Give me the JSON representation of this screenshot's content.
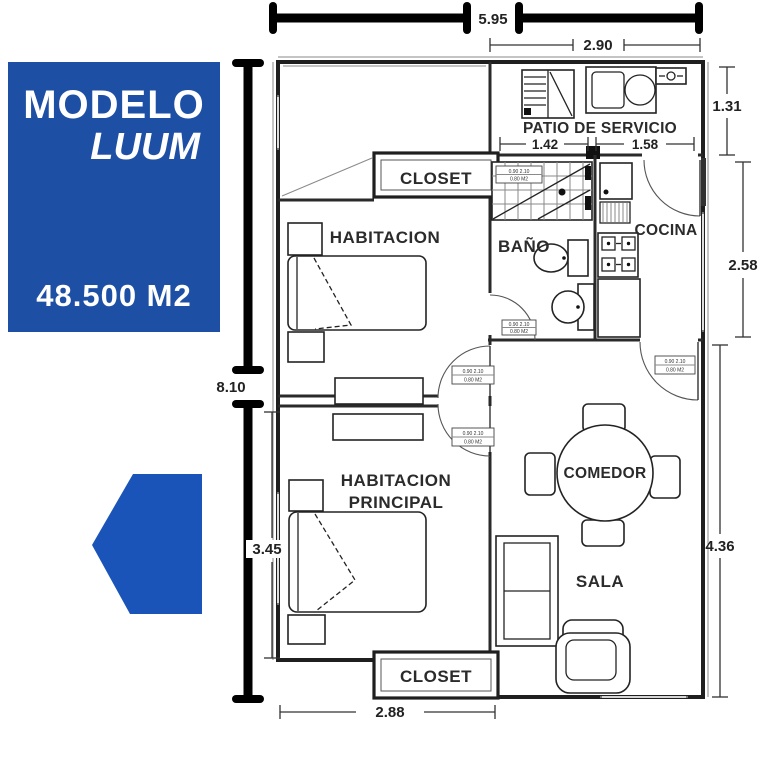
{
  "title_card": {
    "line1": "MODELO",
    "line2": "LUUM",
    "area": "48.500 M2"
  },
  "rooms": {
    "closet": "CLOSET",
    "habitacion": "HABITACION",
    "patio": "PATIO DE SERVICIO",
    "bano": "BAÑO",
    "cocina": "COCINA",
    "principal_l1": "HABITACION",
    "principal_l2": "PRINCIPAL",
    "comedor": "COMEDOR",
    "sala": "SALA"
  },
  "dimensions": {
    "top_width": "5.95",
    "patio_width": "2.90",
    "patio_height": "1.31",
    "patio_split_left": "1.42",
    "patio_split_right": "1.58",
    "cocina_height": "2.58",
    "total_height": "8.10",
    "principal_height": "3.45",
    "sala_height": "4.36",
    "bottom_width": "2.88"
  },
  "spec_tag": {
    "line1": "0.90  2.10",
    "line2": "0.80 M2"
  },
  "colors": {
    "brand_blue": "#1d4fa4",
    "arrow_blue": "#1a54b8",
    "wall": "#1f1f1f",
    "dimension_text": "#222222"
  }
}
